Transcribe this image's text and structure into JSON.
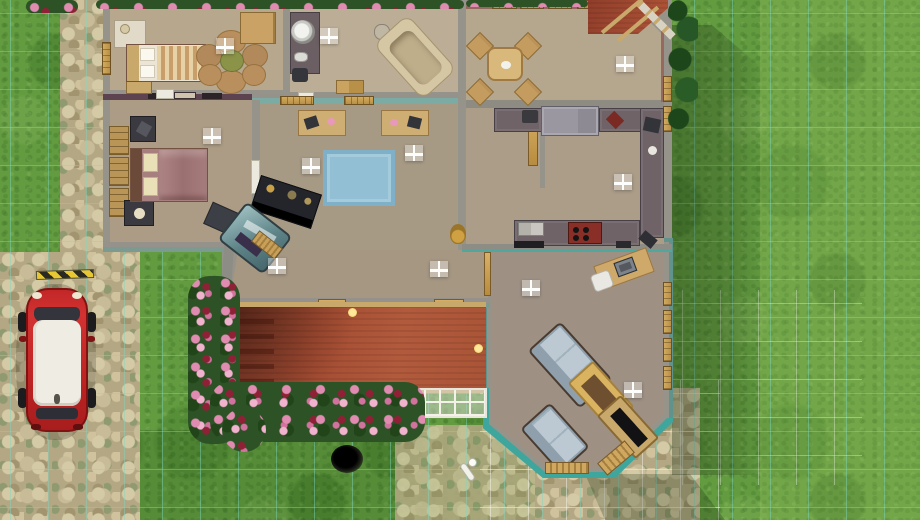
{
  "scene": {
    "title": "Life-simulation game — top-down overhead view of a furnished single-storey house lot",
    "view": "top-down build/buy overview",
    "ground": {
      "terrain": [
        "grass lawn",
        "stone pebble driveway (left)",
        "stone patio (bottom right of porch)"
      ],
      "grids": [
        "teal build grid over lawn (38px cells)",
        "white room-outline grid near house (bottom-right)"
      ],
      "lighting": "daylight, house shadow cast to the right"
    },
    "vehicle": {
      "type": "compact hatchback car",
      "body_color": "#c02424",
      "roof_color": "#efece4",
      "location": "parked vertically on stone driveway, left side",
      "extras": [
        "yellow-black striped parking marker above car"
      ]
    },
    "rooms": [
      {
        "id": "bedroom-1",
        "position": "top-left",
        "furniture": [
          "double bed with cream/tan striped bedding and white pillows",
          "white changing table",
          "wooden nightstand",
          "flower-shaped tan rug with olive center",
          "wooden wardrobe"
        ],
        "windows": [
          "3 on top wall",
          "1 on left wall"
        ],
        "ceiling_lamps": 1
      },
      {
        "id": "master-bedroom",
        "position": "middle-left",
        "accent_wall": "#5d4350 plum with 3 framed pictures",
        "furniture": [
          "double bed with mauve blanket and cream pillows",
          "2 dark nightstands",
          "3 wooden bookcases along left wall",
          "dark desk set diagonally",
          "white door to study"
        ],
        "ceiling_lamps": 1
      },
      {
        "id": "bathroom",
        "position": "top-center",
        "furniture": [
          "dark vanity counter with round mirror",
          "corner bathtub set diagonally",
          "toilet",
          "wooden storage boxes"
        ],
        "windows": [
          "3 on top wall"
        ],
        "ceiling_lamps": 1
      },
      {
        "id": "study",
        "position": "center",
        "accent_wall": "#7caba3 teal top wall",
        "furniture": [
          "2 wooden activity desks with dark machines and pink items",
          "light-blue area rug",
          "dark curio display cabinet (diagonal)",
          "curved glass display case (diagonal)",
          "slatted bench"
        ],
        "ceiling_lamps": 2
      },
      {
        "id": "dining-room",
        "position": "top-right",
        "wall_finish": "mauve",
        "furniture": [
          "round wooden dining table with white plate",
          "4 wooden chairs at diagonal corners"
        ],
        "windows": [
          "4 flower-box windows on top wall",
          "2 on right wall"
        ],
        "ceiling_lamps": 1,
        "exterior": "red entry roof with wooden beams over clipped top-right corner"
      },
      {
        "id": "kitchen",
        "position": "right-center",
        "furniture": [
          "U-shaped dark gray counters",
          "gray refrigerator",
          "red stove with burners",
          "double sink",
          "coffee maker",
          "diagonal spice racks",
          "tall golden pantry door"
        ],
        "ceiling_lamps": 1
      },
      {
        "id": "hallway",
        "position": "center-bottom",
        "furniture": [
          "brass jug planter",
          "2 golden doors to porch"
        ],
        "ceiling_lamps": 2
      },
      {
        "id": "living-room",
        "position": "bottom-right",
        "exterior_wall_color": "#3fa69e teal, bay window at bottom",
        "furniture": [
          "wooden computer desk (diagonal) with monitor and white chair",
          "long sofa with blue-gray cushions (diagonal)",
          "loveseat (diagonal)",
          "wooden coffee table with dark inlay (diagonal)",
          "wooden TV stand with black TV (diagonal)",
          "slatted shelf at bay",
          "window bench"
        ],
        "windows": [
          "4 on right wall",
          "bay windows on bottom"
        ],
        "ceiling_lamps": 2
      }
    ],
    "porch": {
      "roof_color": "terracotta #a85038 with shingle lines and wooden beam edges",
      "lights": 2,
      "attachments": [
        "white lattice strip below roof",
        "white-framed glass roof panels at right end"
      ]
    },
    "garden": {
      "plants": [
        "pink/crimson rose hedge along top wall",
        "rose bushes left of porch",
        "rose bed below porch",
        "dark shrubs along right dining wall",
        "small rose bush top-left corner"
      ],
      "objects": [
        "black garden hole",
        "white sprinkler on patio stones"
      ]
    },
    "colors": {
      "grass": "#639b40",
      "grass_light": "#8db95c",
      "grid_teal": "#7dd6c4",
      "stone": "#b3a883",
      "wall_top": "#96948a",
      "floor_tan": "#b2a28a",
      "accent_plum": "#5d4350",
      "accent_teal_wall": "#7caba3",
      "exterior_teal": "#3fa69e",
      "roof_red": "#a85038",
      "wood": "#c9a86b",
      "counter_gray": "#6f6368",
      "rug_blue": "#92bfd3",
      "car_red": "#c02424",
      "flower_pink": "#e08bb0"
    }
  }
}
